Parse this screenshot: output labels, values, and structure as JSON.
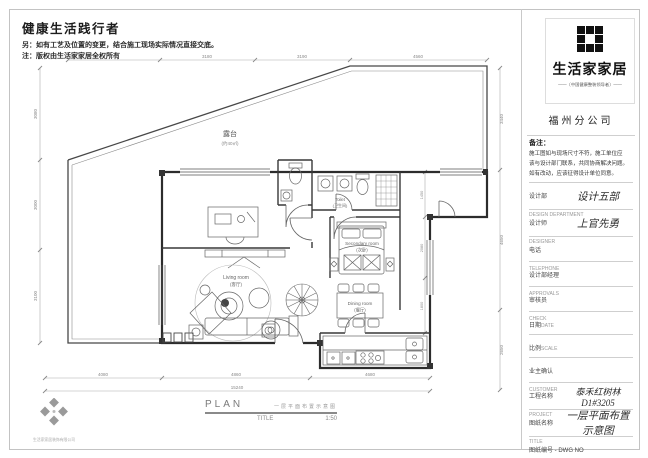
{
  "header": {
    "title": "健康生活践行者",
    "note1": "另：如有工艺及位置的变更，结合施工现场实际情况直接交底。",
    "note2": "注：版权由生活家家居全权所有"
  },
  "brand": {
    "logo_name": "生活家家居",
    "tagline": "——〔中国健康整装领导者〕——",
    "branch": "福州分公司"
  },
  "remarks": {
    "label": "备注：",
    "line1": "施工图如与现场尺寸不符，施工单位应",
    "line2": "该与设计部门联系，共同协商解决问题。",
    "line3": "如有改动，应该征得设计单位同意。"
  },
  "fields": [
    {
      "label": "设计部",
      "en": "DESIGN DEPARTMENT",
      "value": "设计五部"
    },
    {
      "label": "设计师",
      "en": "DESIGNER",
      "value": "上官先勇"
    },
    {
      "label": "电话",
      "en": "TELEPHONE",
      "value": ""
    },
    {
      "label": "设计部经理",
      "en": "APPROVALS",
      "value": ""
    },
    {
      "label": "审核员",
      "en": "CHECK",
      "value": ""
    },
    {
      "label": "日期",
      "en": "DATE",
      "value": ""
    },
    {
      "label": "比例",
      "en": "SCALE",
      "value": ""
    },
    {
      "label": "业主确认",
      "en": "CUSTOMER",
      "value": ""
    },
    {
      "label": "工程名称",
      "en": "PROJECT",
      "value": "泰禾红树林D1#3205"
    },
    {
      "label": "图纸名称",
      "en": "TITLE",
      "value": "一层平面布置示意图"
    },
    {
      "label": "图纸编号 - DWG NO",
      "en": "",
      "value": ""
    }
  ],
  "plan": {
    "labels": {
      "terrace": "露台",
      "terrace_area": "(约40㎡)",
      "living_en": "Living room",
      "living_cn": "(客厅)",
      "bedroom_en": "Secondary room",
      "bedroom_cn": "(次卧)",
      "dining_en": "Dining room",
      "dining_cn": "(餐厅)",
      "toilet_en": "Toilet",
      "toilet_cn": "(卫生间)"
    },
    "dims": {
      "top": [
        "3090",
        "3180",
        "3190",
        "4560"
      ],
      "left": [
        "3080",
        "3000",
        "3100"
      ],
      "right": [
        "3440",
        "4650",
        "2650"
      ],
      "inner_right": [
        "1450",
        "2080",
        "1800"
      ],
      "bottom": [
        "4080",
        "4860",
        "4680"
      ],
      "bottom_total": "15240"
    },
    "footer": {
      "plan": "PLAN",
      "title_cn": "一层平面布置示意图",
      "title_label": "TITLE",
      "scale": "1:50"
    },
    "compass_caption": "生活家家居装饰有限公司"
  }
}
